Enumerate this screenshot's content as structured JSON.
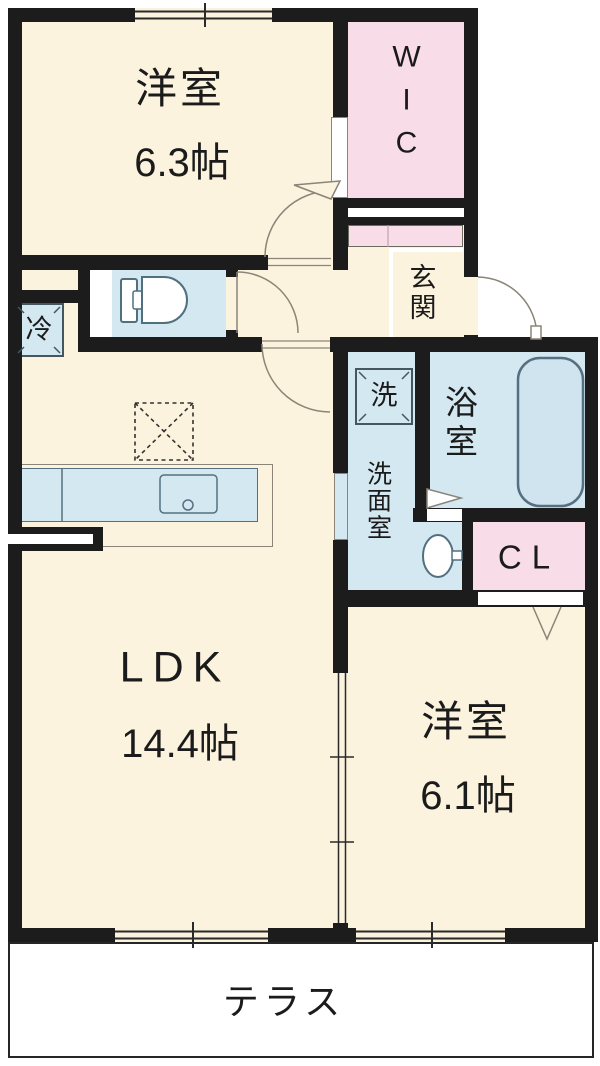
{
  "plan": {
    "rooms": {
      "bedroom_main": {
        "name": "洋室",
        "size": "6.3帖"
      },
      "wic": {
        "label": "WIC"
      },
      "genkan": {
        "label": "玄関"
      },
      "fridge": {
        "label": "冷"
      },
      "washer": {
        "label": "洗"
      },
      "washroom": {
        "label": "洗面室"
      },
      "bathroom": {
        "label": "浴室"
      },
      "closet": {
        "label": "CL"
      },
      "ldk": {
        "name": "LDK",
        "size": "14.4帖"
      },
      "bedroom_second": {
        "name": "洋室",
        "size": "6.1帖"
      },
      "terrace": {
        "label": "テラス"
      }
    },
    "colors": {
      "room_fill": "#fbf3dd",
      "closet_fill": "#f8dce8",
      "water_fill": "#d4e8f2",
      "wall": "#1c1c1c",
      "line": "#8a8578",
      "fixture_outline": "#50707e",
      "terrace_fill": "#ffffff"
    }
  }
}
